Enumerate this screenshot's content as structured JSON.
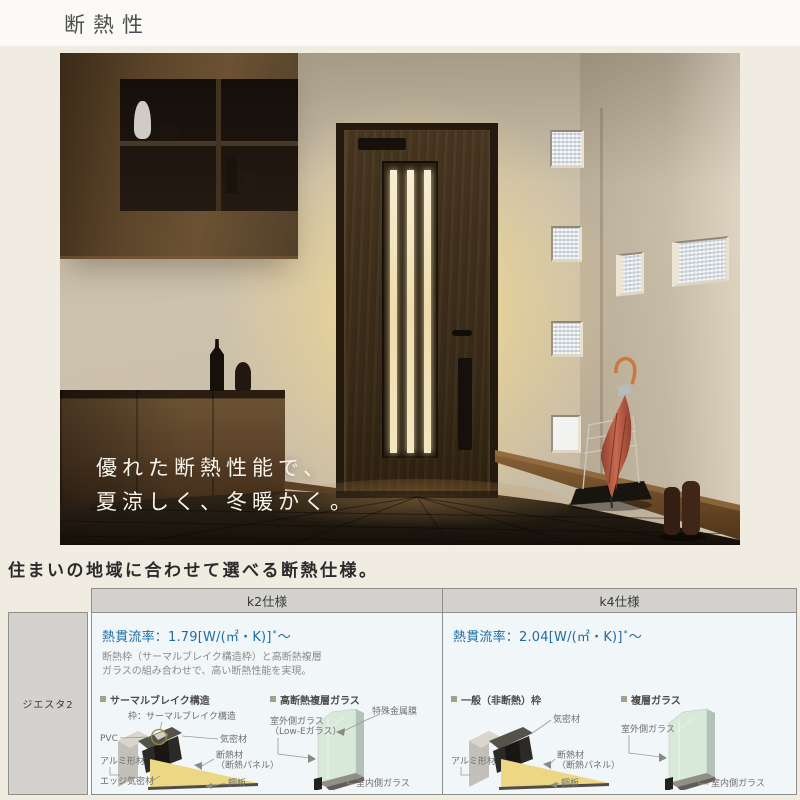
{
  "page": {
    "title": "断熱性"
  },
  "hero": {
    "caption_line1": "優れた断熱性能で、",
    "caption_line2": "夏涼しく、冬暖かく。"
  },
  "intro": {
    "heading": "住まいの地域に合わせて選べる断熱仕様。"
  },
  "table": {
    "row_label": "ジエスタ2",
    "k2": {
      "header": "k2仕様",
      "u_value": "熱貫流率：1.79[W/(㎡・K)]",
      "u_mark": "*",
      "u_tilde": "～",
      "desc_line1": "断熱枠（サーマルブレイク構造枠）と高断熱複層",
      "desc_line2": "ガラスの組み合わせで、高い断熱性能を実現。",
      "frame": {
        "title": "サーマルブレイク構造",
        "anchor": "枠：サーマルブレイク構造",
        "pvc": "PVC",
        "airtight": "気密材",
        "aluminum": "アルミ形材",
        "insulation_line1": "断熱材",
        "insulation_line2": "（断熱パネル）",
        "edge": "エッジ気密材",
        "steel": "鋼板"
      },
      "glass": {
        "title": "高断熱複層ガラス",
        "film": "特殊金属膜",
        "outer_line1": "室外側ガラス",
        "outer_line2": "（Low-Eガラス）",
        "inner": "室内側ガラス"
      }
    },
    "k4": {
      "header": "k4仕様",
      "u_value": "熱貫流率：2.04[W/(㎡・K)]",
      "u_mark": "*",
      "u_tilde": "～",
      "frame": {
        "title": "一般（非断熱）枠",
        "airtight": "気密材",
        "aluminum": "アルミ形材",
        "insulation_line1": "断熱材",
        "insulation_line2": "（断熱パネル）",
        "steel": "鋼板"
      },
      "glass": {
        "title": "複層ガラス",
        "outer": "室外側ガラス",
        "inner": "室内側ガラス"
      }
    }
  },
  "colors": {
    "accent_blue": "#1d6da5",
    "table_gray": "#d3d2cf",
    "cell_bg": "#f1f6f8",
    "page_bg": "#f0ece1",
    "bullet": "#a3a08c",
    "glow": "#f6dd96"
  }
}
